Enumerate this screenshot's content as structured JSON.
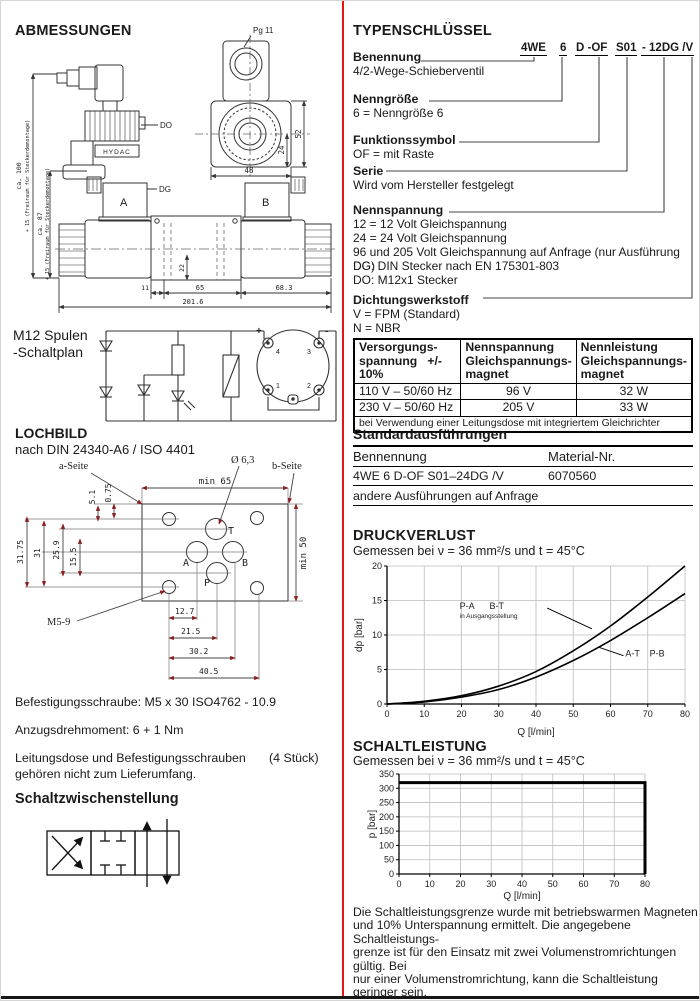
{
  "page": {
    "accent_red": "#ee1111",
    "dim_arrow_color": "#8b1a1a"
  },
  "left": {
    "abmessungen_title": "ABMESSUNGEN",
    "drawing": {
      "pg11": "Pg 11",
      "do": "DO",
      "dg": "DG",
      "hydac": "HYDAC",
      "sol_a": "A",
      "sol_b": "B",
      "dim48": "48",
      "dim52": "52",
      "dim24": "24",
      "dim11": "11",
      "dim65": "65",
      "dim68_3": "68.3",
      "dim201_6": "201.6",
      "dim22": "22",
      "ca100": "ca. 100",
      "ca100_note": "+ 15 (Freiraum für Steckerdemontage)",
      "ca87": "ca. 87",
      "ca87_note": "+ 15 (Freiraum für Steckerdemontage)"
    },
    "m12_line1": "M12 Spulen",
    "m12_line2": "-Schaltplan",
    "m12": {
      "plus": "+",
      "minus": "-",
      "pin1": "1",
      "pin2": "2",
      "pin3": "3",
      "pin4": "4"
    },
    "lochbild_title": "LOCHBILD",
    "lochbild_subtitle": "nach DIN 24340-A6 / ISO 4401",
    "lochbild": {
      "a_seite": "a-Seite",
      "b_seite": "b-Seite",
      "diameter": "Ø 6,3",
      "m5": "M5-9",
      "min65": "min 65",
      "min50": "min 50",
      "d31_75": "31.75",
      "d31": "31",
      "d25_9": "25.9",
      "d15_5": "15.5",
      "d5_1": "5.1",
      "d0_75": "0.75",
      "d12_7": "12.7",
      "d21_5": "21.5",
      "d30_2": "30.2",
      "d40_5": "40.5",
      "port_a": "A",
      "port_b": "B",
      "port_p": "P",
      "port_t": "T"
    },
    "befestigung": "Befestigungsschraube: M5 x 30 ISO4762 - 10.9",
    "anzugsdrehmoment": "Anzugsdrehmoment: 6 + 1 Nm",
    "leitungsdose_line1": "Leitungsdose und Befestigungsschrauben",
    "leitungsdose_qty": "(4 Stück)",
    "leitungsdose_line2": "gehören nicht zum Lieferumfang.",
    "schaltzwischenstellung_title": "Schaltzwischenstellung"
  },
  "right": {
    "typenschluessel_title": "TYPENSCHLÜSSEL",
    "code": {
      "seg1": "4WE",
      "seg2": "6",
      "seg3": "D -OF",
      "seg4": "S01",
      "seg5": "- 12DG /V"
    },
    "sections": [
      {
        "label": "Benennung",
        "lines": [
          "4/2-Wege-Schieberventil"
        ]
      },
      {
        "label": "Nenngröße",
        "lines": [
          "6 = Nenngröße 6"
        ]
      },
      {
        "label": "Funktionssymbol",
        "lines": [
          "OF = mit Raste"
        ]
      },
      {
        "label": "Serie",
        "lines": [
          "Wird vom Hersteller festgelegt"
        ]
      },
      {
        "label": "Nennspannung",
        "lines": [
          "12 = 12 Volt Gleichspannung",
          "24 = 24 Volt Gleichspannung",
          "96 und 205 Volt Gleichspannung auf Anfrage (nur Ausführung DG)",
          "DG: DIN Stecker nach EN 175301-803",
          "DO: M12x1 Stecker"
        ]
      },
      {
        "label": "Dichtungswerkstoff",
        "lines": [
          "V = FPM (Standard)",
          "N = NBR"
        ]
      }
    ],
    "voltage_table": {
      "col1_header": [
        "Versorgungs-",
        "spannung   +/- 10%"
      ],
      "col2_header": [
        "Nennspannung",
        "Gleichspannungs-",
        "magnet"
      ],
      "col3_header": [
        "Nennleistung",
        "Gleichspannungs-",
        "magnet"
      ],
      "rows": [
        [
          "110 V – 50/60 Hz",
          "96 V",
          "32 W"
        ],
        [
          "230 V – 50/60 Hz",
          "205 V",
          "33 W"
        ]
      ],
      "footer": "bei Verwendung einer Leitungsdose mit integriertem Gleichrichter"
    },
    "standard": {
      "title": "Standardausführungen",
      "col1": "Bennennung",
      "col2": "Material-Nr.",
      "row_name": "4WE 6 D-OF S01–24DG /V",
      "row_nr": "6070560",
      "note": "andere Ausführungen auf Anfrage"
    },
    "footnote_lines": [
      "Die Schaltleistungsgrenze wurde mit betriebswarmen Magneten",
      "und 10% Unterspannung ermittelt. Die angegebene Schaltleistungs-",
      "grenze ist für den Einsatz mit zwei Volumenstromrichtungen gültig. Bei",
      "nur einer Volumenstromrichtung, kann die Schaltleistung geringer sein.",
      "Einschränkung der Schaltleistung für Spulen G96/G205:",
      "der im Diagramm angegebene max. zul. Volumenstrom ist um",
      "10% zu verringern. Die Schaltzeiten sind verlängert."
    ]
  },
  "chart_data": [
    {
      "type": "line",
      "title": "DRUCKVERLUST",
      "subtitle": "Gemessen bei ν  = 36 mm²/s und t = 45°C",
      "xlabel": "Q [l/min]",
      "ylabel": "dp [bar]",
      "xlim": [
        0,
        80
      ],
      "ylim": [
        0,
        20
      ],
      "xticks": [
        0,
        10,
        20,
        30,
        40,
        50,
        60,
        70,
        80
      ],
      "yticks": [
        0,
        5,
        10,
        15,
        20
      ],
      "grid": true,
      "legend_position": "none",
      "series": [
        {
          "name": "P-A / B-T (in Ausgangsstellung)",
          "smooth": true,
          "x": [
            0,
            10,
            20,
            30,
            40,
            50,
            60,
            70,
            80
          ],
          "y": [
            0,
            0.4,
            1.2,
            2.6,
            4.7,
            7.7,
            11.3,
            15.5,
            20
          ]
        },
        {
          "name": "A-T / P-B",
          "smooth": true,
          "x": [
            0,
            10,
            20,
            30,
            40,
            50,
            60,
            70,
            80
          ],
          "y": [
            0,
            0.3,
            1.0,
            2.1,
            3.9,
            6.3,
            9.2,
            12.5,
            16
          ]
        }
      ],
      "annotations": [
        {
          "text": "P-A",
          "x": 19.5,
          "y": 13.8
        },
        {
          "text": "B-T",
          "x": 27.5,
          "y": 13.8
        },
        {
          "text": "in Ausgangsstellung",
          "x": 19.5,
          "y": 12.5,
          "small": true
        },
        {
          "text": "A-T",
          "x": 64,
          "y": 6.9
        },
        {
          "text": "P-B",
          "x": 70.5,
          "y": 6.9
        }
      ],
      "leaders": [
        {
          "x1": 43,
          "y1": 13.9,
          "x2": 55,
          "y2": 10.9
        },
        {
          "x1": 57,
          "y1": 8.2,
          "x2": 63.5,
          "y2": 7.0
        }
      ]
    },
    {
      "type": "line",
      "title": "SCHALTLEISTUNG",
      "subtitle": "Gemessen bei ν  = 36 mm²/s und t = 45°C",
      "xlabel": "Q [l/min]",
      "ylabel": "p [bar]",
      "xlim": [
        0,
        80
      ],
      "ylim": [
        0,
        350
      ],
      "xticks": [
        0,
        10,
        20,
        30,
        40,
        50,
        60,
        70,
        80
      ],
      "yticks": [
        0,
        50,
        100,
        150,
        200,
        250,
        300,
        350
      ],
      "grid": true,
      "legend_position": "none",
      "series": [
        {
          "name": "Schaltleistungsgrenze",
          "smooth": false,
          "thick": true,
          "x": [
            0,
            80,
            80
          ],
          "y": [
            320,
            320,
            0
          ]
        }
      ],
      "annotations": [],
      "leaders": []
    }
  ]
}
